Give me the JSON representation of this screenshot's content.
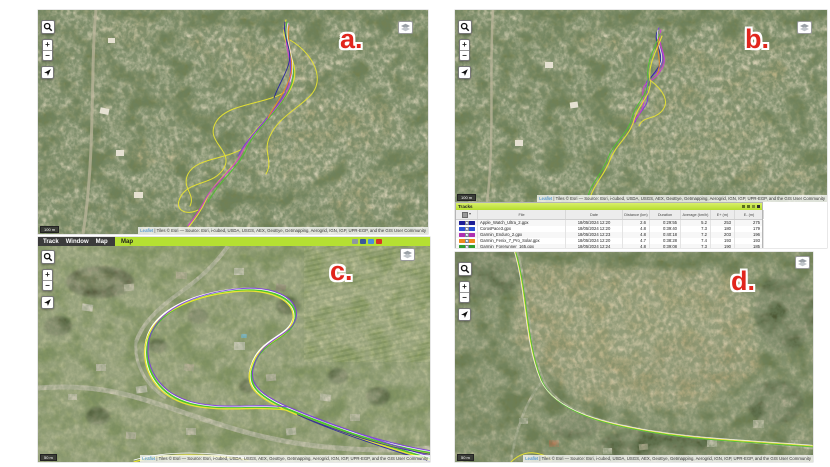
{
  "attribution": {
    "leaflet": "Leaflet",
    "text": "| Tiles © Esri — Source: Esri, i-cubed, USDA, USGS, AEX, GeoEye, Getmapping, Aerogrid, IGN, IGP, UPR-EGP, and the GIS User Community"
  },
  "map_controls": {
    "zoom_in": "+",
    "zoom_out": "−"
  },
  "panels": {
    "a": {
      "label": "a.",
      "scale_label": "100 m"
    },
    "b": {
      "label": "b.",
      "scale_label": "100 m"
    },
    "c": {
      "label": "c.",
      "scale_label": "50 m",
      "menu": {
        "items": [
          "Track",
          "Window",
          "Map"
        ],
        "active_tab": "Map"
      }
    },
    "d": {
      "label": "d.",
      "scale_label": "50 m"
    }
  },
  "tracks_table": {
    "title": "Tracks",
    "columns": [
      "File",
      "Date",
      "Distance (km)",
      "Duration",
      "Average (km/h)",
      "E+ (m)",
      "E- (m)"
    ],
    "rows": [
      {
        "color": "#1c1e96",
        "file": "Apple_Watch_Ultra_2.gpx",
        "date": "18/05/2024 12:20",
        "distance": "2.6",
        "duration": "0:29:55",
        "average": "5.2",
        "e_plus": "253",
        "e_minus": "275"
      },
      {
        "color": "#2a52d4",
        "file": "CorosPace3.gpx",
        "date": "18/05/2024 12:20",
        "distance": "4.8",
        "duration": "0:39:40",
        "average": "7.3",
        "e_plus": "180",
        "e_minus": "179"
      },
      {
        "color": "#b02fb0",
        "file": "Garmin_Enduro_2.gpx",
        "date": "18/05/2024 12:23",
        "distance": "4.8",
        "duration": "0:40:18",
        "average": "7.2",
        "e_plus": "203",
        "e_minus": "196"
      },
      {
        "color": "#f08a1e",
        "file": "Garmin_Fenix_7_Pro_Solar.gpx",
        "date": "18/05/2024 12:20",
        "distance": "4.7",
        "duration": "0:38:28",
        "average": "7.4",
        "e_plus": "193",
        "e_minus": "193"
      },
      {
        "color": "#2f9e2f",
        "file": "Garmin_Forerunner_165.gpx",
        "date": "18/05/2024 12:24",
        "distance": "4.8",
        "duration": "0:39:08",
        "average": "7.3",
        "e_plus": "190",
        "e_minus": "185"
      }
    ]
  },
  "track_colors": {
    "yellow": "#e8e431",
    "magenta": "#cf3ed0",
    "purple": "#7b3fd9",
    "green": "#4fc32e",
    "orange": "#f08a1e",
    "navy": "#2624a0",
    "white": "#ffffff"
  }
}
